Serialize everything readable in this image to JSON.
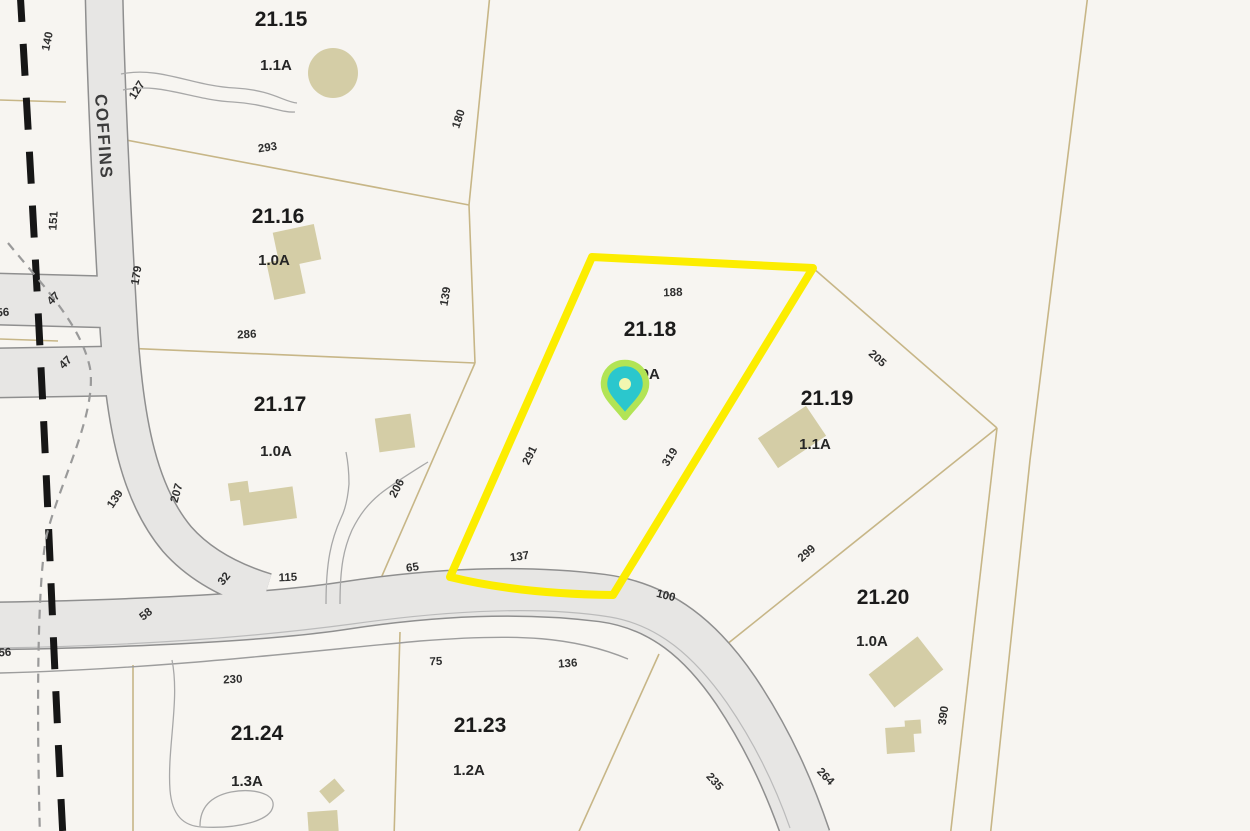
{
  "map": {
    "colors": {
      "background": "#f7f5f1",
      "parcel_line": "#c7b687",
      "road_fill": "#e7e6e4",
      "road_edge": "#8f8f8f",
      "road_centerline": "#bbbbbb",
      "road_row_line": "#9d9d9d",
      "driveway": "#a8a8a8",
      "building": "#d4cda6",
      "boundary_dash": "#161616",
      "dash_gray": "#9a9a9a",
      "highlight": "#fced00",
      "pin_glow": "#b2e455",
      "pin_body": "#2bc7cd",
      "pin_center": "#f2f7b0"
    },
    "road_name_label": {
      "text": "COFFINS",
      "x": 98,
      "y": 137,
      "rotation": 86
    },
    "selected_parcel": {
      "id": "21.18",
      "outline": "M592,257 L813,268 L613,595 Q520,594 450,577 Z"
    },
    "pin": {
      "body": "M625,417 C616,405 604,396 604,384 C604,372 613,363 625,363 C637,363 646,372 646,384 C646,396 634,405 625,417 Z",
      "center_x": 625,
      "center_y": 384,
      "center_r": 6
    },
    "parcels": [
      {
        "number": "21.15",
        "acreage": "1.1A",
        "nx": 281,
        "ny": 26,
        "ax": 276,
        "ay": 70
      },
      {
        "number": "21.16",
        "acreage": "1.0A",
        "nx": 278,
        "ny": 223,
        "ax": 274,
        "ay": 265
      },
      {
        "number": "21.17",
        "acreage": "1.0A",
        "nx": 280,
        "ny": 411,
        "ax": 276,
        "ay": 456
      },
      {
        "number": "21.18",
        "acreage": "1.0A",
        "nx": 650,
        "ny": 336,
        "ax": 644,
        "ay": 379
      },
      {
        "number": "21.19",
        "acreage": "1.1A",
        "nx": 827,
        "ny": 405,
        "ax": 815,
        "ay": 449
      },
      {
        "number": "21.20",
        "acreage": "1.0A",
        "nx": 883,
        "ny": 604,
        "ax": 872,
        "ay": 646
      },
      {
        "number": "21.23",
        "acreage": "1.2A",
        "nx": 480,
        "ny": 732,
        "ax": 469,
        "ay": 775
      },
      {
        "number": "21.24",
        "acreage": "1.3A",
        "nx": 257,
        "ny": 740,
        "ax": 247,
        "ay": 786
      }
    ],
    "dimension_labels": [
      {
        "t": "140",
        "x": 51,
        "y": 42,
        "r": -78
      },
      {
        "t": "127",
        "x": 140,
        "y": 92,
        "r": -58
      },
      {
        "t": "151",
        "x": 57,
        "y": 221,
        "r": -86
      },
      {
        "t": "179",
        "x": 140,
        "y": 276,
        "r": -80
      },
      {
        "t": "293",
        "x": 268,
        "y": 151,
        "r": -8
      },
      {
        "t": "180",
        "x": 462,
        "y": 120,
        "r": -72
      },
      {
        "t": "139",
        "x": 449,
        "y": 297,
        "r": -80
      },
      {
        "t": "286",
        "x": 247,
        "y": 338,
        "r": -3
      },
      {
        "t": "47",
        "x": 56,
        "y": 301,
        "r": -45
      },
      {
        "t": "47",
        "x": 68,
        "y": 365,
        "r": -45
      },
      {
        "t": "56",
        "x": 3,
        "y": 316,
        "r": -3
      },
      {
        "t": "139",
        "x": 118,
        "y": 501,
        "r": -56
      },
      {
        "t": "207",
        "x": 180,
        "y": 494,
        "r": -74
      },
      {
        "t": "206",
        "x": 400,
        "y": 490,
        "r": -62
      },
      {
        "t": "32",
        "x": 227,
        "y": 581,
        "r": -52
      },
      {
        "t": "115",
        "x": 288,
        "y": 581,
        "r": -2
      },
      {
        "t": "65",
        "x": 413,
        "y": 571,
        "r": -8
      },
      {
        "t": "58",
        "x": 148,
        "y": 617,
        "r": -38
      },
      {
        "t": "56",
        "x": 5,
        "y": 656,
        "r": -3
      },
      {
        "t": "188",
        "x": 673,
        "y": 296,
        "r": -2
      },
      {
        "t": "291",
        "x": 533,
        "y": 457,
        "r": -64
      },
      {
        "t": "319",
        "x": 673,
        "y": 459,
        "r": -58
      },
      {
        "t": "137",
        "x": 520,
        "y": 560,
        "r": -8
      },
      {
        "t": "100",
        "x": 665,
        "y": 599,
        "r": 14
      },
      {
        "t": "205",
        "x": 875,
        "y": 361,
        "r": 42
      },
      {
        "t": "299",
        "x": 809,
        "y": 556,
        "r": -42
      },
      {
        "t": "230",
        "x": 233,
        "y": 683,
        "r": -3
      },
      {
        "t": "75",
        "x": 436,
        "y": 665,
        "r": -2
      },
      {
        "t": "136",
        "x": 568,
        "y": 667,
        "r": -4
      },
      {
        "t": "235",
        "x": 712,
        "y": 784,
        "r": 48
      },
      {
        "t": "264",
        "x": 823,
        "y": 779,
        "r": 46
      },
      {
        "t": "390",
        "x": 947,
        "y": 716,
        "r": -82
      }
    ],
    "geometry": {
      "roads": [
        {
          "name": "coffins",
          "d": "M104,-8 C106,90 112,210 118,315 C124,430 141,496 177,539 C199,564 230,581 266,592",
          "w": 36
        },
        {
          "name": "main",
          "d": "M-8,626 C120,624 262,618 342,606 C432,592 522,588 602,598 C662,606 702,641 736,691 C770,742 791,791 807,838",
          "w": 46
        },
        {
          "name": "stub-upper",
          "d": "M-6,299 L110,302",
          "w": 50
        },
        {
          "name": "stub-lower",
          "d": "M-6,373 L114,371",
          "w": 48
        }
      ],
      "road_lines": [
        {
          "d": "M-8,648 C140,646 262,636 352,624 C452,610 542,606 610,617 C658,625 694,656 727,703 C756,745 776,788 790,828",
          "w": 1.2,
          "c": "#bbbbbb"
        },
        {
          "d": "M0,673 C160,669 300,652 420,641 C520,633 575,637 628,659",
          "w": 1.4,
          "c": "#9d9d9d"
        }
      ],
      "parcel_lines": [
        "M121,139 L469,205",
        "M490,-6 L469,205",
        "M469,205 L475,363",
        "M99,347 L475,363",
        "M475,363 L378,585",
        "M813,268 L997,428",
        "M997,428 L706,661",
        "M1088,-6 L1030,460 L990,838",
        "M997,428 L950,838",
        "M659,654 L576,838",
        "M400,632 L394,838",
        "M133,665 L133,838",
        "M0,100 L66,102",
        "M0,284 L58,286",
        "M0,319 L96,321",
        "M0,368 L96,369",
        "M0,339 L58,341"
      ],
      "dashed_bold": {
        "d": "M20,-10 C30,160 40,330 50,560 C56,700 60,780 63,838",
        "w": 7,
        "dash": "32 22"
      },
      "dashed_thin": {
        "d": "M8,243 C45,288 81,325 90,368 C97,412 62,478 48,530 C38,565 36,690 40,838",
        "w": 2.2,
        "dash": "9 7"
      },
      "driveways": [
        "M121,74 C160,66 192,86 235,88 C272,90 284,102 297,103",
        "M123,90 C160,82 192,100 233,102 C266,104 281,113 295,112",
        "M326,604 C326,562 331,540 341,518 C346,508 348,496 349,484",
        "M340,604 C340,566 344,548 352,530 C360,514 368,504 380,494",
        "M349,484 C349,472 348,462 346,452",
        "M380,494 C394,483 412,472 428,462",
        "M172,660 C180,700 167,748 170,790 C172,815 183,826 202,827 C237,829 271,821 273,806 C275,793 252,788 231,792 C212,796 200,806 200,826"
      ],
      "buildings": [
        {
          "type": "circle",
          "cx": 333,
          "cy": 73,
          "r": 25
        },
        {
          "type": "rect",
          "cx": 297,
          "cy": 246,
          "w": 42,
          "h": 36,
          "rot": -12
        },
        {
          "type": "rect",
          "cx": 286,
          "cy": 278,
          "w": 32,
          "h": 38,
          "rot": -12
        },
        {
          "type": "rect",
          "cx": 395,
          "cy": 433,
          "w": 36,
          "h": 34,
          "rot": -8
        },
        {
          "type": "rect",
          "cx": 268,
          "cy": 506,
          "w": 54,
          "h": 32,
          "rot": -8
        },
        {
          "type": "rect",
          "cx": 239,
          "cy": 491,
          "w": 20,
          "h": 18,
          "rot": -8
        },
        {
          "type": "rect",
          "cx": 792,
          "cy": 437,
          "w": 58,
          "h": 36,
          "rot": -34
        },
        {
          "type": "rect",
          "cx": 906,
          "cy": 672,
          "w": 62,
          "h": 42,
          "rot": -38
        },
        {
          "type": "rect",
          "cx": 900,
          "cy": 740,
          "w": 28,
          "h": 26,
          "rot": -4
        },
        {
          "type": "rect",
          "cx": 913,
          "cy": 727,
          "w": 16,
          "h": 14,
          "rot": -4
        },
        {
          "type": "rect",
          "cx": 332,
          "cy": 791,
          "w": 20,
          "h": 16,
          "rot": -40
        },
        {
          "type": "rect",
          "cx": 323,
          "cy": 822,
          "w": 30,
          "h": 22,
          "rot": -4
        }
      ]
    }
  }
}
